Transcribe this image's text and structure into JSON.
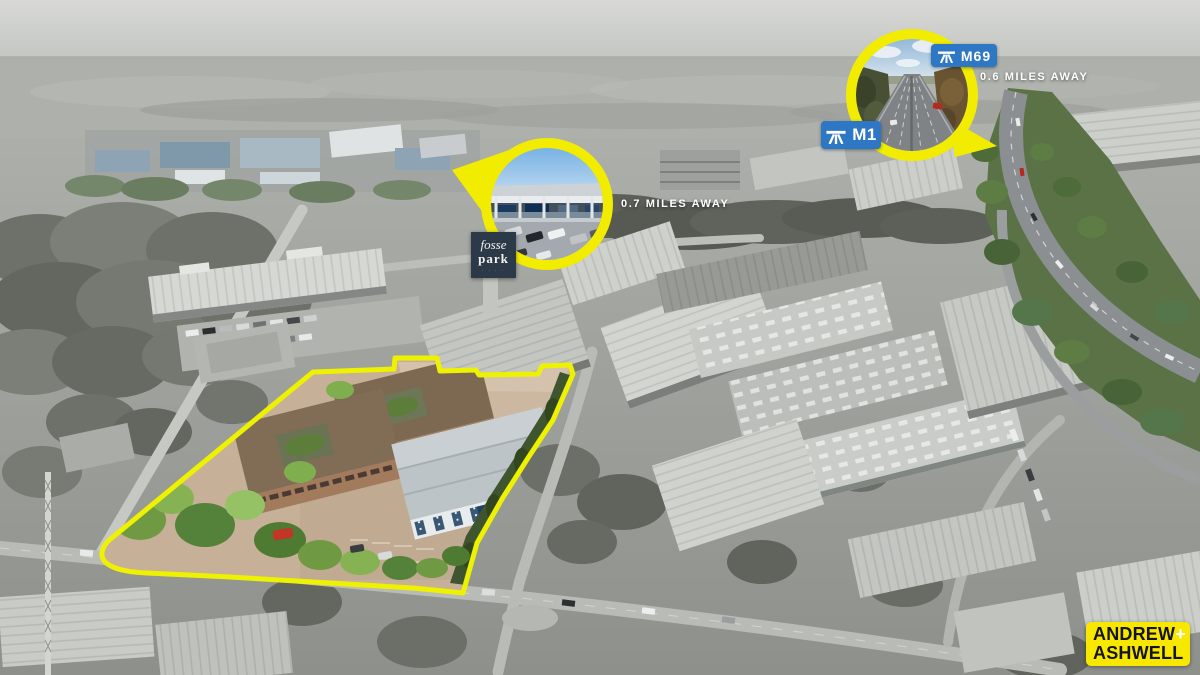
{
  "image": {
    "type": "aerial-marketing-photograph",
    "description": "Grayscale aerial view of an industrial estate; the marketed site is outlined in yellow and shown in colour, with two circular photo callouts for nearby amenities"
  },
  "colors": {
    "site_outline_yellow": "#eef200",
    "circle_ring_yellow": "#f1ec00",
    "sign_blue": "#2e77c5",
    "badge_navy": "#2c3949",
    "logo_yellow": "#f8e800"
  },
  "callouts": [
    {
      "id": "fosse-park",
      "distance": "0.7 MILES AWAY"
    },
    {
      "id": "m1-m69-motorways",
      "distance": "0.6 MILES AWAY"
    }
  ],
  "road_signs": [
    {
      "id": "m69",
      "label": "M69"
    },
    {
      "id": "m1",
      "label": "M1"
    }
  ],
  "fosse_badge": {
    "line1": "fosse",
    "line2": "park",
    "tagline": "· · · ·"
  },
  "brand": {
    "name_top": "ANDREW",
    "plus": "+",
    "name_bottom": "ASHWELL"
  }
}
